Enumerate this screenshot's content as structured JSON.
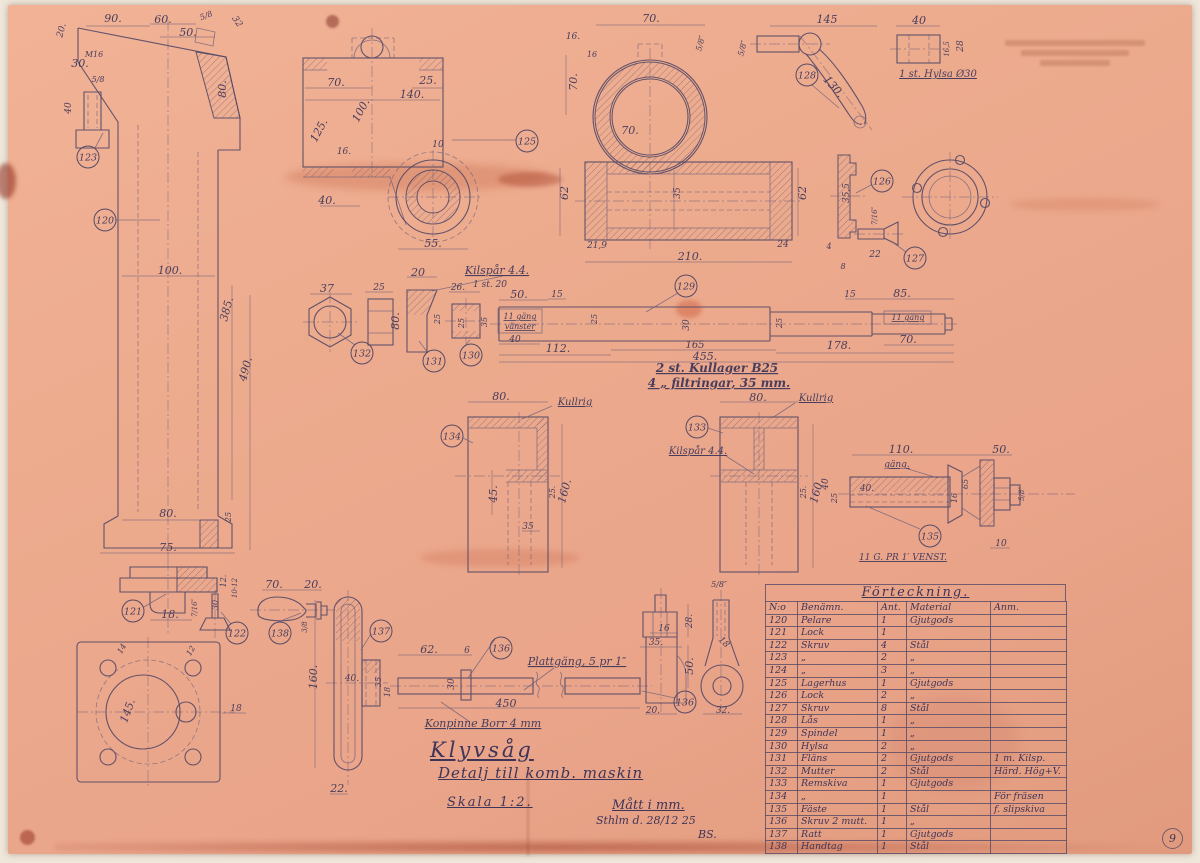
{
  "page": {
    "number": "9"
  },
  "title_block": {
    "title": "Klyvsåg",
    "subtitle": "Detalj till komb. maskin",
    "scale": "Skala 1:2.",
    "units": "Mått i mm.",
    "place_date": "Sthlm d. 28/12 25",
    "signature": "BS."
  },
  "colors": {
    "paper": "#ecab8e",
    "ink": "#564a66",
    "stain": "#a34f35"
  },
  "parts_table": {
    "title": "Förteckning.",
    "headers": [
      "N:o",
      "Benämn.",
      "Ant.",
      "Material",
      "Anm."
    ],
    "rows": [
      [
        "120",
        "Pelare",
        "1",
        "Gjutgods",
        ""
      ],
      [
        "121",
        "Lock",
        "1",
        "",
        ""
      ],
      [
        "122",
        "Skruv",
        "4",
        "Stål",
        ""
      ],
      [
        "123",
        "„",
        "2",
        "„",
        ""
      ],
      [
        "124",
        "„",
        "3",
        "„",
        ""
      ],
      [
        "125",
        "Lagerhus",
        "1",
        "Gjutgods",
        ""
      ],
      [
        "126",
        "Lock",
        "2",
        "„",
        ""
      ],
      [
        "127",
        "Skruv",
        "8",
        "Stål",
        ""
      ],
      [
        "128",
        "Lås",
        "1",
        "„",
        ""
      ],
      [
        "129",
        "Spindel",
        "1",
        "„",
        ""
      ],
      [
        "130",
        "Hylsa",
        "2",
        "„",
        ""
      ],
      [
        "131",
        "Fläns",
        "2",
        "Gjutgods",
        "1 m. Kilsp."
      ],
      [
        "132",
        "Mutter",
        "2",
        "Stål",
        "Härd. Hög+V."
      ],
      [
        "133",
        "Remskiva",
        "1",
        "Gjutgods",
        ""
      ],
      [
        "134",
        "„",
        "1",
        "",
        "För fräsen"
      ],
      [
        "135",
        "Fäste",
        "1",
        "Stål",
        "f. slipskiva"
      ],
      [
        "136",
        "Skruv 2 mutt.",
        "1",
        "„",
        ""
      ],
      [
        "137",
        "Ratt",
        "1",
        "Gjutgods",
        ""
      ],
      [
        "138",
        "Handtag",
        "1",
        "Stål",
        ""
      ]
    ]
  },
  "balloons": [
    {
      "n": "120",
      "x": 105,
      "y": 220
    },
    {
      "n": "123",
      "x": 88,
      "y": 157
    },
    {
      "n": "121",
      "x": 133,
      "y": 611
    },
    {
      "n": "122",
      "x": 237,
      "y": 633
    },
    {
      "n": "138",
      "x": 280,
      "y": 633
    },
    {
      "n": "137",
      "x": 381,
      "y": 631
    },
    {
      "n": "136",
      "x": 501,
      "y": 648
    },
    {
      "n": "136",
      "x": 685,
      "y": 702
    },
    {
      "n": "132",
      "x": 362,
      "y": 353
    },
    {
      "n": "131",
      "x": 434,
      "y": 361
    },
    {
      "n": "130",
      "x": 471,
      "y": 355
    },
    {
      "n": "129",
      "x": 686,
      "y": 286
    },
    {
      "n": "125",
      "x": 527,
      "y": 141
    },
    {
      "n": "128",
      "x": 807,
      "y": 75
    },
    {
      "n": "126",
      "x": 882,
      "y": 181
    },
    {
      "n": "127",
      "x": 915,
      "y": 258
    },
    {
      "n": "133",
      "x": 697,
      "y": 427
    },
    {
      "n": "134",
      "x": 452,
      "y": 436
    },
    {
      "n": "135",
      "x": 930,
      "y": 536
    }
  ],
  "annotations": [
    {
      "t": "20.",
      "x": 64,
      "y": 31,
      "r": -75,
      "s": 9
    },
    {
      "t": "90.",
      "x": 113,
      "y": 22
    },
    {
      "t": "60.",
      "x": 163,
      "y": 23
    },
    {
      "t": "50.",
      "x": 188,
      "y": 36
    },
    {
      "t": "5/8",
      "x": 207,
      "y": 18,
      "s": 8,
      "r": -20
    },
    {
      "t": "32",
      "x": 235,
      "y": 23,
      "r": 55,
      "s": 9
    },
    {
      "t": "M16",
      "x": 94,
      "y": 57,
      "s": 8
    },
    {
      "t": "30.",
      "x": 80,
      "y": 67
    },
    {
      "t": "5/8",
      "x": 98,
      "y": 82,
      "s": 8
    },
    {
      "t": "40",
      "x": 71,
      "y": 108,
      "r": -90,
      "s": 9
    },
    {
      "t": "80.",
      "x": 226,
      "y": 89,
      "r": -90
    },
    {
      "t": "100.",
      "x": 170,
      "y": 274
    },
    {
      "t": "385.",
      "x": 230,
      "y": 310,
      "r": -75
    },
    {
      "t": "490.",
      "x": 249,
      "y": 370,
      "r": -75
    },
    {
      "t": "80.",
      "x": 168,
      "y": 517
    },
    {
      "t": "25",
      "x": 231,
      "y": 517,
      "r": -90,
      "s": 8
    },
    {
      "t": "75.",
      "x": 168,
      "y": 551
    },
    {
      "t": "12.",
      "x": 226,
      "y": 581,
      "r": -90,
      "s": 8
    },
    {
      "t": "10-12",
      "x": 237,
      "y": 588,
      "r": -90,
      "s": 7
    },
    {
      "t": "30",
      "x": 218,
      "y": 605,
      "r": -90,
      "s": 8
    },
    {
      "t": "7/16″",
      "x": 197,
      "y": 608,
      "r": -90,
      "s": 7
    },
    {
      "t": "18.",
      "x": 170,
      "y": 618
    },
    {
      "t": "14",
      "x": 124,
      "y": 650,
      "r": -60,
      "s": 8
    },
    {
      "t": "12",
      "x": 193,
      "y": 652,
      "r": -60,
      "s": 8
    },
    {
      "t": "145.",
      "x": 131,
      "y": 712,
      "r": -70
    },
    {
      "t": "18",
      "x": 236,
      "y": 711,
      "s": 9
    },
    {
      "t": "70.",
      "x": 274,
      "y": 588
    },
    {
      "t": "20.",
      "x": 313,
      "y": 588
    },
    {
      "t": "3/8",
      "x": 307,
      "y": 627,
      "r": -90,
      "s": 7
    },
    {
      "t": "160.",
      "x": 317,
      "y": 677,
      "r": -90
    },
    {
      "t": "40.",
      "x": 352,
      "y": 681,
      "s": 9
    },
    {
      "t": "35",
      "x": 381,
      "y": 682,
      "r": -90,
      "s": 8
    },
    {
      "t": "18",
      "x": 390,
      "y": 692,
      "r": -90,
      "s": 8
    },
    {
      "t": "22.",
      "x": 339,
      "y": 792
    },
    {
      "t": "70.",
      "x": 336,
      "y": 86
    },
    {
      "t": "25.",
      "x": 428,
      "y": 84
    },
    {
      "t": "140.",
      "x": 412,
      "y": 98
    },
    {
      "t": "100.",
      "x": 364,
      "y": 112,
      "r": -62
    },
    {
      "t": "125.",
      "x": 322,
      "y": 132,
      "r": -62
    },
    {
      "t": "16.",
      "x": 344,
      "y": 154,
      "s": 9
    },
    {
      "t": "10",
      "x": 438,
      "y": 147,
      "s": 9
    },
    {
      "t": "40.",
      "x": 327,
      "y": 204
    },
    {
      "t": "55.",
      "x": 433,
      "y": 247
    },
    {
      "t": "70.",
      "x": 651,
      "y": 22
    },
    {
      "t": "16.",
      "x": 573,
      "y": 39,
      "s": 9
    },
    {
      "t": "16",
      "x": 592,
      "y": 57,
      "s": 8
    },
    {
      "t": "5/8″",
      "x": 703,
      "y": 44,
      "r": -75,
      "s": 8
    },
    {
      "t": "70.",
      "x": 577,
      "y": 82,
      "r": -90
    },
    {
      "t": "70.",
      "x": 630,
      "y": 134
    },
    {
      "t": "62",
      "x": 568,
      "y": 193,
      "r": -90
    },
    {
      "t": "35",
      "x": 680,
      "y": 193,
      "r": -90,
      "s": 9
    },
    {
      "t": "62",
      "x": 806,
      "y": 193,
      "r": -90
    },
    {
      "t": "21,9",
      "x": 597,
      "y": 248,
      "s": 9
    },
    {
      "t": "24",
      "x": 783,
      "y": 247,
      "s": 9
    },
    {
      "t": "210.",
      "x": 690,
      "y": 260
    },
    {
      "t": "35,5",
      "x": 849,
      "y": 193,
      "r": -90,
      "s": 9
    },
    {
      "t": "4",
      "x": 829,
      "y": 249,
      "s": 8
    },
    {
      "t": "8",
      "x": 843,
      "y": 269,
      "s": 8
    },
    {
      "t": "7/16″",
      "x": 877,
      "y": 216,
      "r": -90,
      "s": 7
    },
    {
      "t": "22",
      "x": 875,
      "y": 257,
      "s": 9
    },
    {
      "t": "145",
      "x": 827,
      "y": 23
    },
    {
      "t": "5/8″",
      "x": 745,
      "y": 49,
      "r": -75,
      "s": 8
    },
    {
      "t": "130.",
      "x": 831,
      "y": 89,
      "r": 48
    },
    {
      "t": "40",
      "x": 919,
      "y": 24
    },
    {
      "t": "16,5",
      "x": 949,
      "y": 49,
      "r": -90,
      "s": 7
    },
    {
      "t": "28",
      "x": 963,
      "y": 46,
      "r": -90,
      "s": 9
    },
    {
      "t": "1 st. Hylsa Ø30",
      "x": 938,
      "y": 77,
      "u": 1,
      "s": 10
    },
    {
      "t": "37",
      "x": 327,
      "y": 292
    },
    {
      "t": "25",
      "x": 379,
      "y": 290,
      "s": 9
    },
    {
      "t": "20",
      "x": 418,
      "y": 276
    },
    {
      "t": "Kilspår 4.4.",
      "x": 497,
      "y": 274,
      "u": 1
    },
    {
      "t": "1 st. 20",
      "x": 490,
      "y": 287,
      "s": 9
    },
    {
      "t": "80.",
      "x": 399,
      "y": 321,
      "r": -90
    },
    {
      "t": "25",
      "x": 440,
      "y": 319,
      "r": -90,
      "s": 8
    },
    {
      "t": "26.",
      "x": 458,
      "y": 290,
      "s": 9
    },
    {
      "t": "25",
      "x": 464,
      "y": 323,
      "r": -90,
      "s": 8
    },
    {
      "t": "35",
      "x": 487,
      "y": 322,
      "r": -90,
      "s": 8
    },
    {
      "t": "50.",
      "x": 519,
      "y": 298
    },
    {
      "t": "15",
      "x": 557,
      "y": 297,
      "s": 9
    },
    {
      "t": "11 gäng",
      "x": 520,
      "y": 319,
      "s": 8,
      "u": 1
    },
    {
      "t": "vänster",
      "x": 520,
      "y": 329,
      "s": 8,
      "u": 1
    },
    {
      "t": "40",
      "x": 515,
      "y": 342,
      "s": 9
    },
    {
      "t": "112.",
      "x": 558,
      "y": 352
    },
    {
      "t": "25",
      "x": 597,
      "y": 319,
      "r": -90,
      "s": 8
    },
    {
      "t": "30",
      "x": 689,
      "y": 325,
      "r": -90,
      "s": 9
    },
    {
      "t": "165",
      "x": 695,
      "y": 348,
      "s": 10
    },
    {
      "t": "455.",
      "x": 705,
      "y": 360
    },
    {
      "t": "25",
      "x": 782,
      "y": 323,
      "r": -90,
      "s": 8
    },
    {
      "t": "178.",
      "x": 839,
      "y": 349
    },
    {
      "t": "15",
      "x": 850,
      "y": 297,
      "s": 9
    },
    {
      "t": "85.",
      "x": 902,
      "y": 297
    },
    {
      "t": "11 gäng",
      "x": 908,
      "y": 320,
      "s": 8,
      "u": 1
    },
    {
      "t": "70.",
      "x": 908,
      "y": 343
    },
    {
      "t": "2 st. Kullager B25",
      "x": 717,
      "y": 372,
      "s": 12,
      "u": 1,
      "b": 1
    },
    {
      "t": "4 „ filtringar, 35 mm.",
      "x": 719,
      "y": 387,
      "s": 12,
      "u": 1,
      "b": 1
    },
    {
      "t": "80.",
      "x": 501,
      "y": 400
    },
    {
      "t": "Kullrig",
      "x": 575,
      "y": 405,
      "u": 1,
      "s": 10
    },
    {
      "t": "45.",
      "x": 497,
      "y": 494,
      "r": -90
    },
    {
      "t": "25.",
      "x": 555,
      "y": 492,
      "r": -90,
      "s": 8
    },
    {
      "t": "160.",
      "x": 568,
      "y": 492,
      "r": -75
    },
    {
      "t": "35",
      "x": 528,
      "y": 529,
      "s": 9
    },
    {
      "t": "80.",
      "x": 758,
      "y": 401
    },
    {
      "t": "Kullrig",
      "x": 816,
      "y": 401,
      "u": 1,
      "s": 10
    },
    {
      "t": "Kilspår 4.4.",
      "x": 698,
      "y": 454,
      "u": 1,
      "s": 10
    },
    {
      "t": "25.",
      "x": 806,
      "y": 492,
      "r": -90,
      "s": 8
    },
    {
      "t": "160.",
      "x": 820,
      "y": 492,
      "r": -75
    },
    {
      "t": "110.",
      "x": 901,
      "y": 453
    },
    {
      "t": "gäng.",
      "x": 897,
      "y": 467,
      "s": 9,
      "u": 1
    },
    {
      "t": "50.",
      "x": 1001,
      "y": 453
    },
    {
      "t": "40",
      "x": 828,
      "y": 484,
      "r": -90,
      "s": 9
    },
    {
      "t": "25",
      "x": 837,
      "y": 498,
      "r": -90,
      "s": 8
    },
    {
      "t": "40.",
      "x": 867,
      "y": 491,
      "s": 9
    },
    {
      "t": "16",
      "x": 957,
      "y": 498,
      "r": -90,
      "s": 8
    },
    {
      "t": "65",
      "x": 968,
      "y": 484,
      "r": -90,
      "s": 8
    },
    {
      "t": "5/8″",
      "x": 1024,
      "y": 494,
      "r": -90,
      "s": 7
    },
    {
      "t": "10",
      "x": 1001,
      "y": 546,
      "s": 9
    },
    {
      "t": "11 G. PR 1′ VENST.",
      "x": 903,
      "y": 560,
      "s": 9,
      "u": 1
    },
    {
      "t": "62.",
      "x": 429,
      "y": 653
    },
    {
      "t": "6",
      "x": 467,
      "y": 653,
      "s": 9
    },
    {
      "t": "30",
      "x": 454,
      "y": 684,
      "r": -90,
      "s": 9
    },
    {
      "t": "450",
      "x": 506,
      "y": 707
    },
    {
      "t": "Plattgäng, 5 pr 1″",
      "x": 577,
      "y": 665,
      "u": 1
    },
    {
      "t": "Konpinne Borr 4 mm",
      "x": 483,
      "y": 727,
      "u": 1
    },
    {
      "t": "5/8″",
      "x": 719,
      "y": 587,
      "s": 8
    },
    {
      "t": "28.",
      "x": 692,
      "y": 621,
      "r": -90,
      "s": 9
    },
    {
      "t": "16",
      "x": 664,
      "y": 631,
      "s": 9
    },
    {
      "t": "35.",
      "x": 656,
      "y": 645,
      "s": 9
    },
    {
      "t": "50.",
      "x": 693,
      "y": 666,
      "r": -90
    },
    {
      "t": "18",
      "x": 722,
      "y": 644,
      "r": 45,
      "s": 9
    },
    {
      "t": "20.",
      "x": 653,
      "y": 713,
      "s": 9
    },
    {
      "t": "32.",
      "x": 723,
      "y": 713,
      "s": 9
    }
  ]
}
